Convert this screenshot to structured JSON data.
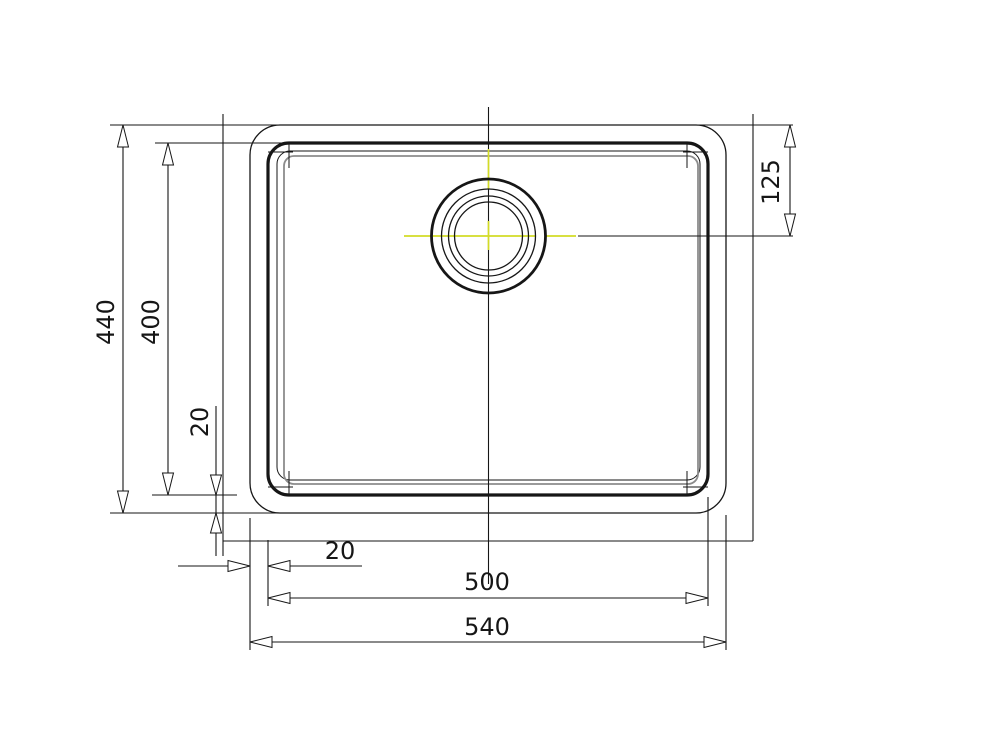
{
  "drawing": {
    "type": "sink-technical-drawing-top-view",
    "dimensions": {
      "overall_height": "440",
      "bowl_height": "400",
      "rim_offset_left": "20",
      "drain_center_from_top": "125",
      "rim_offset_bottom": "20",
      "bowl_width": "500",
      "overall_width": "540"
    },
    "colors": {
      "line": "#161616",
      "bowl_bottom_gray": "#8c8c8c",
      "centerline_yellow": "#d3dc26",
      "background": "#ffffff"
    }
  }
}
